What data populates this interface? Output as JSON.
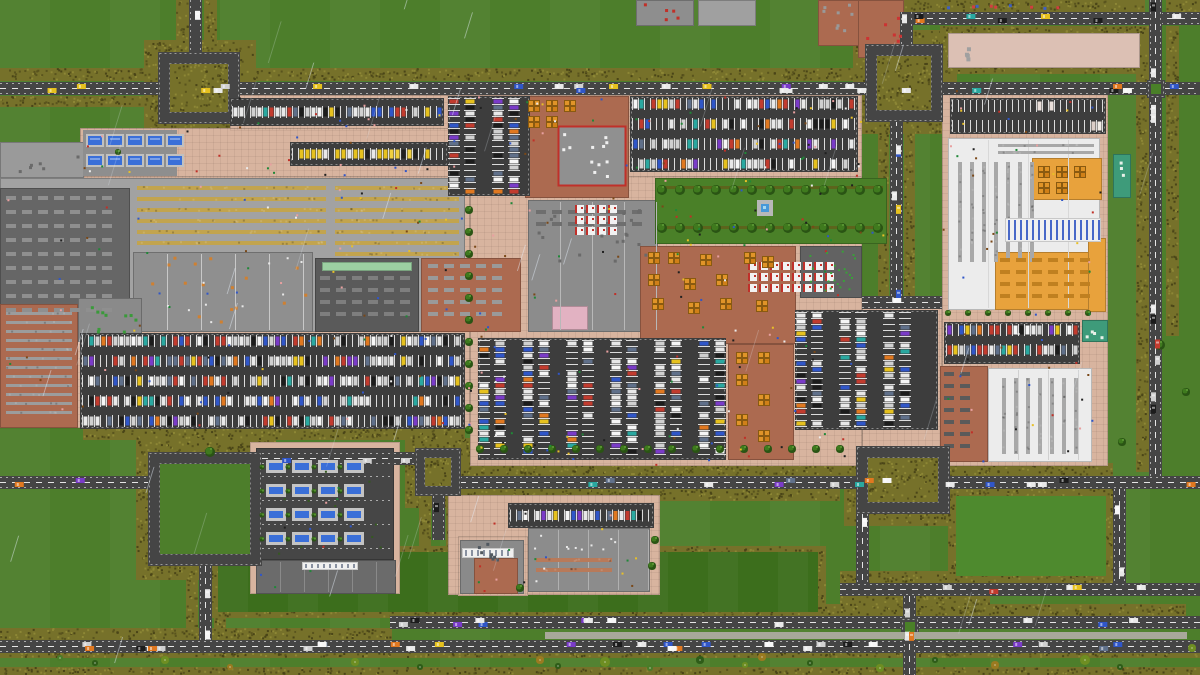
{
  "meta": {
    "title": "Top-down pixel city-builder world map",
    "description": "Zoomed-out aerial view of an industrial retail complex with parking lots, hedge-lined roads, loops, warehouses and rain",
    "weather": "rain"
  },
  "palette": {
    "grass": "#4d7e2b",
    "grassLight": "#578a31",
    "field": "#3c6e1c",
    "hedge": "#76712a",
    "hedgeDark": "#59541e",
    "hedgeLight": "#8d8736",
    "road": "#454545",
    "roadLine": "#e6e6e6",
    "asphalt": "#3d3d3d",
    "stall": "#dcdcdc",
    "pad": "#d8b49f"
  },
  "hedges": [
    [
      0,
      68,
      856,
      13
    ],
    [
      0,
      96,
      228,
      11
    ],
    [
      144,
      40,
      112,
      96
    ],
    [
      176,
      0,
      13,
      52
    ],
    [
      204,
      0,
      13,
      52
    ],
    [
      853,
      30,
      104,
      104
    ],
    [
      903,
      0,
      242,
      12
    ],
    [
      1166,
      0,
      34,
      12
    ],
    [
      940,
      26,
      208,
      48
    ],
    [
      1136,
      26,
      13,
      446
    ],
    [
      1166,
      26,
      13,
      310
    ],
    [
      878,
      96,
      11,
      206
    ],
    [
      904,
      96,
      11,
      206
    ],
    [
      460,
      463,
      386,
      13
    ],
    [
      460,
      489,
      380,
      12
    ],
    [
      955,
      463,
      158,
      13
    ],
    [
      844,
      436,
      120,
      90
    ],
    [
      136,
      440,
      140,
      140
    ],
    [
      405,
      438,
      68,
      70
    ],
    [
      186,
      556,
      12,
      96
    ],
    [
      214,
      556,
      12,
      96
    ],
    [
      210,
      546,
      616,
      72
    ],
    [
      948,
      488,
      166,
      96
    ],
    [
      390,
      604,
      796,
      12
    ],
    [
      0,
      628,
      392,
      12
    ],
    [
      0,
      652,
      1200,
      6
    ],
    [
      0,
      667,
      1200,
      8
    ],
    [
      840,
      571,
      273,
      12
    ],
    [
      840,
      596,
      150,
      10
    ],
    [
      83,
      428,
      382,
      12
    ],
    [
      419,
      496,
      12,
      110
    ],
    [
      446,
      496,
      12,
      110
    ]
  ],
  "fields": {
    "dark": [
      218,
      552,
      600,
      60
    ],
    "islands": [
      [
        956,
        496,
        150,
        80
      ]
    ]
  },
  "pads": [
    [
      230,
      95,
      632,
      35
    ],
    [
      80,
      128,
      782,
      50
    ],
    [
      0,
      176,
      470,
      252
    ],
    [
      470,
      176,
      392,
      290
    ],
    [
      862,
      300,
      80,
      166
    ],
    [
      942,
      88,
      166,
      378
    ],
    [
      448,
      495,
      212,
      100
    ],
    [
      250,
      442,
      150,
      152
    ],
    [
      458,
      536,
      70,
      60
    ]
  ],
  "grid_pads": [
    [
      230,
      95,
      632,
      35
    ],
    [
      80,
      128,
      782,
      50
    ],
    [
      0,
      176,
      470,
      252
    ],
    [
      470,
      176,
      392,
      290
    ],
    [
      862,
      300,
      80,
      166
    ],
    [
      942,
      88,
      166,
      378
    ],
    [
      448,
      495,
      212,
      100
    ],
    [
      948,
      33,
      192,
      35
    ]
  ],
  "zones": [
    {
      "r": [
        0,
        178,
        465,
        154
      ],
      "f": "#a2a2a2"
    },
    {
      "r": [
        0,
        188,
        130,
        144
      ],
      "f": "#666666"
    },
    {
      "r": [
        133,
        252,
        180,
        80
      ],
      "f": "#8f8f8f"
    },
    {
      "r": [
        315,
        258,
        104,
        74
      ],
      "f": "#5a5a5a"
    },
    {
      "r": [
        421,
        258,
        100,
        74
      ],
      "f": "#ac6a50"
    },
    {
      "r": [
        528,
        200,
        130,
        132
      ],
      "f": "#8c8c8c"
    },
    {
      "r": [
        525,
        96,
        104,
        102
      ],
      "f": "#ac6a50"
    },
    {
      "r": [
        558,
        126,
        68,
        60
      ],
      "f": "#909090",
      "s": "#c0302a",
      "sw": 2
    },
    {
      "r": [
        655,
        178,
        232,
        66
      ],
      "f": "#4a8028"
    },
    {
      "r": [
        640,
        246,
        156,
        98
      ],
      "f": "#ac6a50"
    },
    {
      "r": [
        800,
        246,
        62,
        52
      ],
      "f": "#626262"
    },
    {
      "r": [
        728,
        344,
        66,
        116
      ],
      "f": "#ac6a50"
    },
    {
      "r": [
        0,
        304,
        78,
        124
      ],
      "f": "#ac6a50"
    },
    {
      "r": [
        78,
        298,
        64,
        44
      ],
      "f": "#8a8a8a"
    },
    {
      "r": [
        948,
        138,
        152,
        172
      ],
      "f": "#ececec"
    },
    {
      "r": [
        1032,
        158,
        70,
        42
      ],
      "f": "#e8a23c"
    },
    {
      "r": [
        995,
        252,
        107,
        58
      ],
      "f": "#e8a23c"
    },
    {
      "r": [
        988,
        368,
        104,
        94
      ],
      "f": "#ececec"
    },
    {
      "r": [
        940,
        366,
        48,
        96
      ],
      "f": "#ac6a50"
    },
    {
      "r": [
        256,
        448,
        138,
        112
      ],
      "f": "#464646"
    },
    {
      "r": [
        256,
        560,
        140,
        34
      ],
      "f": "#6b6b6b"
    },
    {
      "r": [
        460,
        540,
        64,
        54
      ],
      "f": "#8a8a8a"
    },
    {
      "r": [
        474,
        558,
        44,
        36
      ],
      "f": "#ac6a50"
    },
    {
      "r": [
        528,
        528,
        122,
        64
      ],
      "f": "#8c8c8c"
    },
    {
      "r": [
        0,
        142,
        84,
        36
      ],
      "f": "#9a9a9a"
    },
    {
      "r": [
        636,
        0,
        58,
        26
      ],
      "f": "#8e8e8e"
    },
    {
      "r": [
        698,
        0,
        58,
        26
      ],
      "f": "#a0a0a0"
    },
    {
      "r": [
        818,
        0,
        42,
        46
      ],
      "f": "#ac6a50"
    },
    {
      "r": [
        858,
        0,
        46,
        58
      ],
      "f": "#ac6a50"
    },
    {
      "r": [
        948,
        33,
        192,
        35
      ],
      "f": "#dcc0b4"
    },
    {
      "r": [
        1088,
        238,
        18,
        74
      ],
      "f": "#e8a23c"
    },
    {
      "r": [
        322,
        262,
        90,
        9
      ],
      "f": "#9cd0a2"
    },
    {
      "r": [
        552,
        306,
        36,
        24
      ],
      "f": "#e2b2c2"
    }
  ],
  "partitions": [
    [
      133,
      252,
      180,
      80,
      34,
      "#c8c8c8"
    ],
    [
      528,
      200,
      130,
      132,
      32,
      "#b8b8b8"
    ],
    [
      256,
      560,
      140,
      34,
      24,
      "#8a8a8a"
    ],
    [
      528,
      528,
      122,
      64,
      30,
      "#b0b0b0"
    ],
    [
      988,
      368,
      104,
      94,
      30,
      "#d0d0d0"
    ],
    [
      948,
      138,
      152,
      172,
      40,
      "#d8d8d8"
    ]
  ],
  "shelves": [
    [
      135,
      184,
      193,
      62,
      "#c2a44e",
      4,
      7,
      "h"
    ],
    [
      333,
      184,
      128,
      78,
      "#c2a44e",
      4,
      7,
      "h"
    ],
    [
      4,
      310,
      70,
      112,
      "#9c9c9c",
      3,
      6,
      "h"
    ],
    [
      956,
      160,
      84,
      104,
      "#a8a8a8",
      4,
      8,
      "v"
    ],
    [
      996,
      142,
      100,
      14,
      "#a8a8a8",
      3,
      4,
      "h"
    ],
    [
      1000,
      376,
      84,
      80,
      "#a8a8a8",
      4,
      8,
      "v"
    ],
    [
      534,
      556,
      80,
      22,
      "#b87a5a",
      4,
      6,
      "h"
    ]
  ],
  "machines": [
    [
      6,
      196,
      118,
      128,
      "#8f8f8f",
      14
    ],
    [
      320,
      276,
      92,
      48,
      "#7e7e7e",
      12
    ],
    [
      428,
      264,
      84,
      60,
      "#9a9a9a",
      12
    ],
    [
      944,
      372,
      40,
      84,
      "#5a5a5a",
      12
    ],
    [
      1000,
      258,
      96,
      44,
      "#c08020",
      12
    ],
    [
      536,
      210,
      112,
      26,
      "#6e6e6e",
      12
    ]
  ],
  "roads": [
    [
      0,
      82,
      1200,
      13
    ],
    [
      903,
      12,
      297,
      13
    ],
    [
      189,
      0,
      13,
      55
    ],
    [
      900,
      12,
      13,
      40
    ],
    [
      1149,
      0,
      13,
      476
    ],
    [
      890,
      96,
      13,
      204
    ],
    [
      862,
      296,
      80,
      13
    ],
    [
      0,
      476,
      148,
      13
    ],
    [
      460,
      476,
      740,
      13
    ],
    [
      840,
      583,
      360,
      13
    ],
    [
      856,
      514,
      13,
      69
    ],
    [
      1113,
      489,
      13,
      95
    ],
    [
      199,
      566,
      13,
      82
    ],
    [
      390,
      616,
      810,
      13
    ],
    [
      0,
      640,
      1200,
      13
    ],
    [
      903,
      596,
      13,
      79
    ],
    [
      432,
      496,
      13,
      44
    ],
    [
      262,
      452,
      153,
      13
    ]
  ],
  "loops": [
    {
      "r": [
        158,
        52,
        82,
        72
      ],
      "t": 12,
      "c": "hedge"
    },
    {
      "r": [
        865,
        44,
        78,
        78
      ],
      "t": 12,
      "c": "hedge"
    },
    {
      "r": [
        856,
        446,
        94,
        68
      ],
      "t": 12,
      "c": "hedge"
    },
    {
      "r": [
        148,
        452,
        114,
        114
      ],
      "t": 12,
      "c": "grass"
    },
    {
      "r": [
        415,
        448,
        46,
        48
      ],
      "t": 10,
      "c": "hedge"
    }
  ],
  "roundabouts": [
    [
      1151,
      84,
      10
    ],
    [
      905,
      622,
      10
    ]
  ],
  "post_zones": [
    {
      "r": [
        545,
        632,
        642,
        7
      ],
      "f": "#a8a89a"
    }
  ],
  "parking": [
    {
      "r": [
        80,
        333,
        385,
        96
      ],
      "o": "h",
      "occ": 0.72
    },
    {
      "r": [
        478,
        338,
        248,
        122
      ],
      "o": "v",
      "occ": 0.65
    },
    {
      "r": [
        795,
        310,
        143,
        120
      ],
      "o": "v",
      "occ": 0.68
    },
    {
      "r": [
        230,
        98,
        214,
        28
      ],
      "o": "h",
      "occ": 0.8
    },
    {
      "r": [
        448,
        96,
        82,
        100
      ],
      "o": "v",
      "occ": 0.7
    },
    {
      "r": [
        630,
        96,
        228,
        76
      ],
      "o": "h",
      "occ": 0.66
    },
    {
      "r": [
        944,
        322,
        136,
        42
      ],
      "o": "h",
      "occ": 0.78
    },
    {
      "r": [
        508,
        503,
        146,
        25
      ],
      "o": "h",
      "occ": 0.7
    },
    {
      "r": [
        950,
        98,
        156,
        36
      ],
      "o": "h",
      "occ": 0.12,
      "c": [
        "#eadfda",
        "#f1ece6",
        "#dccfc8"
      ]
    },
    {
      "r": [
        290,
        142,
        158,
        24
      ],
      "o": "h",
      "occ": 0.85,
      "c": [
        "#e6c11e",
        "#e6c11e",
        "#e6c11e",
        "#f0d040",
        "#e8e8e8",
        "#202020"
      ]
    }
  ],
  "checkouts": [
    [
      575,
      205,
      44,
      36
    ],
    [
      748,
      262,
      90,
      34
    ]
  ],
  "pallets": [
    [
      528,
      100
    ],
    [
      546,
      100
    ],
    [
      564,
      100
    ],
    [
      528,
      116
    ],
    [
      546,
      116
    ],
    [
      648,
      252
    ],
    [
      668,
      252
    ],
    [
      700,
      254
    ],
    [
      744,
      252
    ],
    [
      762,
      256
    ],
    [
      648,
      274
    ],
    [
      684,
      278
    ],
    [
      716,
      274
    ],
    [
      652,
      298
    ],
    [
      688,
      302
    ],
    [
      720,
      298
    ],
    [
      756,
      300
    ],
    [
      736,
      352
    ],
    [
      758,
      352
    ],
    [
      736,
      374
    ],
    [
      758,
      394
    ],
    [
      736,
      414
    ],
    [
      758,
      430
    ],
    [
      1038,
      166
    ],
    [
      1056,
      166
    ],
    [
      1074,
      166
    ],
    [
      1038,
      182
    ],
    [
      1056,
      182
    ]
  ],
  "conveyors": [
    [
      1005,
      218,
      96,
      24,
      "#4868c8"
    ],
    [
      462,
      548,
      52,
      10,
      "#8890a0"
    ],
    [
      302,
      562,
      56,
      8,
      "#8890a0"
    ]
  ],
  "teal_pads": [
    [
      1113,
      154,
      18,
      44
    ],
    [
      1082,
      320,
      26,
      22
    ]
  ],
  "docks": {
    "top": {
      "plat": [
        83,
        130,
        94,
        46
      ],
      "rows": [
        136,
        156
      ],
      "x0": 88,
      "dx": 20,
      "n": 5,
      "w": 14,
      "h": 9
    },
    "depot": {
      "rows": [
        460,
        484,
        508,
        532
      ],
      "x0": 266,
      "dx": 26,
      "n": 4,
      "w": 20,
      "h": 13
    }
  },
  "dotted_lines": [
    [
      262,
      476,
      392,
      476
    ],
    [
      262,
      500,
      392,
      500
    ],
    [
      262,
      524,
      392,
      524
    ],
    [
      262,
      548,
      392,
      548
    ]
  ],
  "garden": {
    "r": [
      655,
      178,
      232,
      66
    ],
    "rows": [
      186,
      226
    ],
    "fountain": [
      757,
      200
    ]
  },
  "dot_fields": [
    [
      562,
      132,
      58,
      48,
      "#f0f0f0",
      12,
      3
    ],
    [
      804,
      250,
      54,
      44,
      "#3aa03a",
      22,
      2
    ],
    [
      1115,
      158,
      14,
      36,
      "#e8f0e8",
      3,
      3
    ],
    [
      1084,
      322,
      22,
      18,
      "#e8f0e8",
      4,
      3
    ],
    [
      82,
      302,
      56,
      36,
      "#3a9a3a",
      10,
      3
    ],
    [
      952,
      36,
      20,
      28,
      "#a0a0a0",
      4,
      4
    ],
    [
      138,
      256,
      170,
      72,
      "#d08030",
      16,
      3
    ],
    [
      138,
      256,
      170,
      72,
      "#e8e8e8",
      10,
      2
    ],
    [
      534,
      206,
      118,
      60,
      "#6a6a6a",
      18,
      3
    ],
    [
      640,
      2,
      50,
      20,
      "#c03028",
      5,
      3
    ],
    [
      862,
      4,
      40,
      50,
      "#cc3333",
      6,
      3
    ],
    [
      820,
      2,
      38,
      40,
      "#999999",
      8,
      3
    ],
    [
      4,
      146,
      76,
      28,
      "#6a6a6a",
      6,
      3
    ],
    [
      260,
      450,
      130,
      108,
      "#355a20",
      10,
      2
    ],
    [
      466,
      542,
      50,
      20,
      "#505860",
      8,
      3
    ],
    [
      534,
      534,
      110,
      18,
      "#e8e8e8",
      10,
      2
    ],
    [
      940,
      4,
      120,
      6,
      "#d04040",
      5,
      3
    ],
    [
      940,
      4,
      120,
      6,
      "#4060c0",
      4,
      3
    ]
  ],
  "tree_rows": [
    [
      469,
      210,
      0,
      22,
      11,
      4
    ],
    [
      480,
      449,
      24,
      0,
      16,
      4
    ],
    [
      948,
      313,
      20,
      0,
      8,
      3
    ],
    [
      662,
      190,
      18,
      0,
      13,
      5
    ],
    [
      662,
      228,
      18,
      0,
      13,
      5
    ]
  ],
  "trees": [
    [
      210,
      452,
      5
    ],
    [
      655,
      540,
      4
    ],
    [
      652,
      566,
      4
    ],
    [
      520,
      588,
      4
    ],
    [
      1160,
      345,
      5
    ],
    [
      1186,
      392,
      4
    ],
    [
      118,
      152,
      3
    ],
    [
      1122,
      442,
      4
    ]
  ],
  "bushes": [
    [
      355,
      662,
      4,
      0
    ],
    [
      420,
      667,
      3,
      1
    ],
    [
      540,
      660,
      4,
      2
    ],
    [
      558,
      666,
      3,
      1
    ],
    [
      605,
      662,
      5,
      0
    ],
    [
      650,
      668,
      3,
      3
    ],
    [
      700,
      660,
      4,
      1
    ],
    [
      745,
      665,
      3,
      0
    ],
    [
      762,
      657,
      4,
      2
    ],
    [
      810,
      663,
      3,
      1
    ],
    [
      880,
      668,
      4,
      0
    ],
    [
      935,
      660,
      3,
      1
    ],
    [
      995,
      665,
      4,
      2
    ],
    [
      1085,
      660,
      5,
      0
    ],
    [
      1120,
      667,
      3,
      1
    ],
    [
      165,
      660,
      4,
      0
    ],
    [
      95,
      663,
      3,
      1
    ],
    [
      230,
      667,
      3,
      2
    ],
    [
      1192,
      648,
      4,
      0
    ],
    [
      60,
      658,
      3,
      3
    ]
  ],
  "cars": {
    "colors": [
      [
        "#e8e8e8",
        3
      ],
      [
        "#d0d0d0",
        2
      ],
      [
        "#1c1c1c",
        2
      ],
      [
        "#c23b2e",
        1.5
      ],
      [
        "#3056c8",
        1.5
      ],
      [
        "#e6c11e",
        1.2
      ],
      [
        "#7a3bc8",
        0.7
      ],
      [
        "#2aa8a0",
        0.7
      ],
      [
        "#e07820",
        0.7
      ],
      [
        "#60708a",
        1
      ],
      [
        "#f6f6f6",
        2
      ]
    ]
  },
  "road_cars": [
    [
      0,
      26
    ],
    [
      1,
      7
    ],
    [
      2,
      1
    ],
    [
      3,
      1
    ],
    [
      4,
      11
    ],
    [
      5,
      5
    ],
    [
      6,
      1
    ],
    [
      7,
      2
    ],
    [
      8,
      15
    ],
    [
      9,
      5
    ],
    [
      10,
      1
    ],
    [
      11,
      2
    ],
    [
      12,
      2
    ],
    [
      13,
      12
    ],
    [
      14,
      28
    ],
    [
      15,
      3
    ],
    [
      16,
      1
    ],
    [
      17,
      3
    ]
  ],
  "ped_colors": [
    "#202020",
    "#ececec",
    "#c03028",
    "#3056c8",
    "#208838",
    "#e8c028",
    "#7a4818",
    "#e8a0a0"
  ],
  "peds": [
    [
      230,
      96,
      630,
      32,
      35
    ],
    [
      80,
      130,
      780,
      46,
      45
    ],
    [
      0,
      178,
      860,
      250,
      150
    ],
    [
      470,
      432,
      390,
      32,
      28
    ],
    [
      942,
      90,
      164,
      374,
      55
    ],
    [
      448,
      495,
      210,
      98,
      18
    ],
    [
      655,
      180,
      230,
      62,
      12
    ],
    [
      256,
      448,
      138,
      144,
      10
    ]
  ],
  "rain": {
    "n": 46,
    "seed": 1337
  }
}
